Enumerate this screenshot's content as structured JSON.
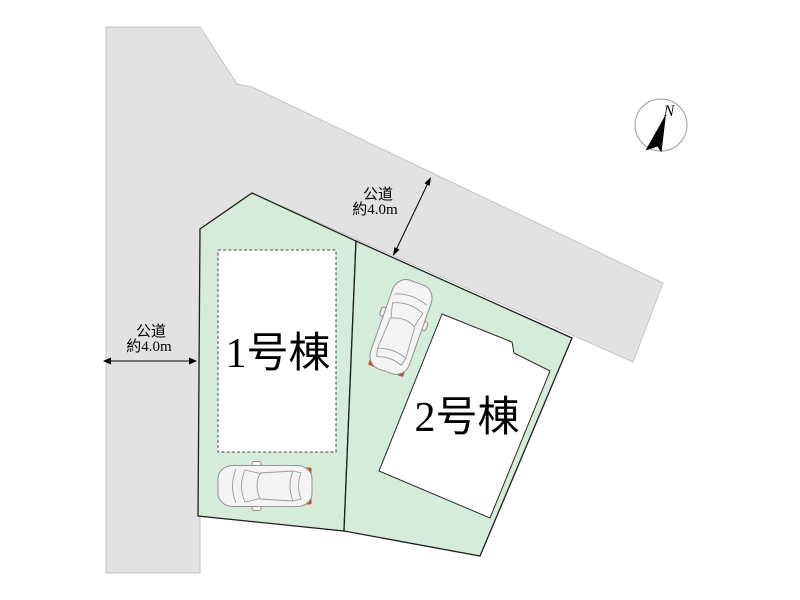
{
  "plan": {
    "type": "site-plan",
    "labels": {
      "left_road": {
        "line1": "公道",
        "line2": "約4.0m"
      },
      "top_road": {
        "line1": "公道",
        "line2": "約4.0m"
      },
      "lot1_building": "1号棟",
      "lot2_building": "2号棟",
      "compass_north": "N"
    },
    "colors": {
      "road_fill": "#e2e2e2",
      "lot_fill": "#d4ecd9",
      "building_fill": "#ffffff",
      "car_fill": "#f4f4f4",
      "car_glass": "#ededed",
      "tail_light": "#c2512e",
      "needle": "#000000"
    }
  }
}
